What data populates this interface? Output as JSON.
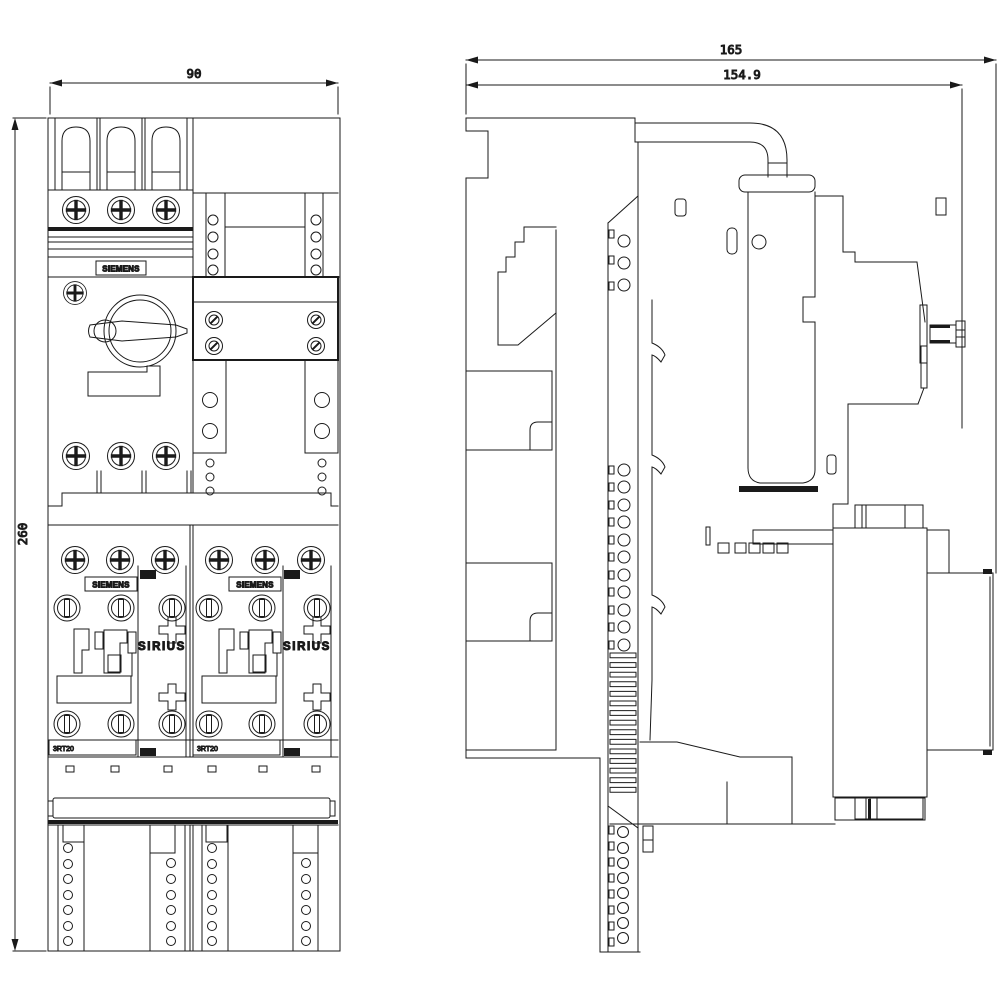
{
  "page": {
    "background": "#ffffff",
    "line_color": "#1a1a1a"
  },
  "front_view": {
    "dimensions": {
      "width": "90",
      "height": "260"
    },
    "circuit_breaker": {
      "brand": "SIEMENS"
    },
    "contactor_left": {
      "brand": "SIEMENS",
      "series": "SIRIUS",
      "type": "3RT20"
    },
    "contactor_right": {
      "brand": "SIEMENS",
      "series": "SIRIUS",
      "type": "3RT20"
    }
  },
  "side_view": {
    "dimensions": {
      "overall_depth": "165",
      "depth_without_handle": "154.9"
    }
  }
}
